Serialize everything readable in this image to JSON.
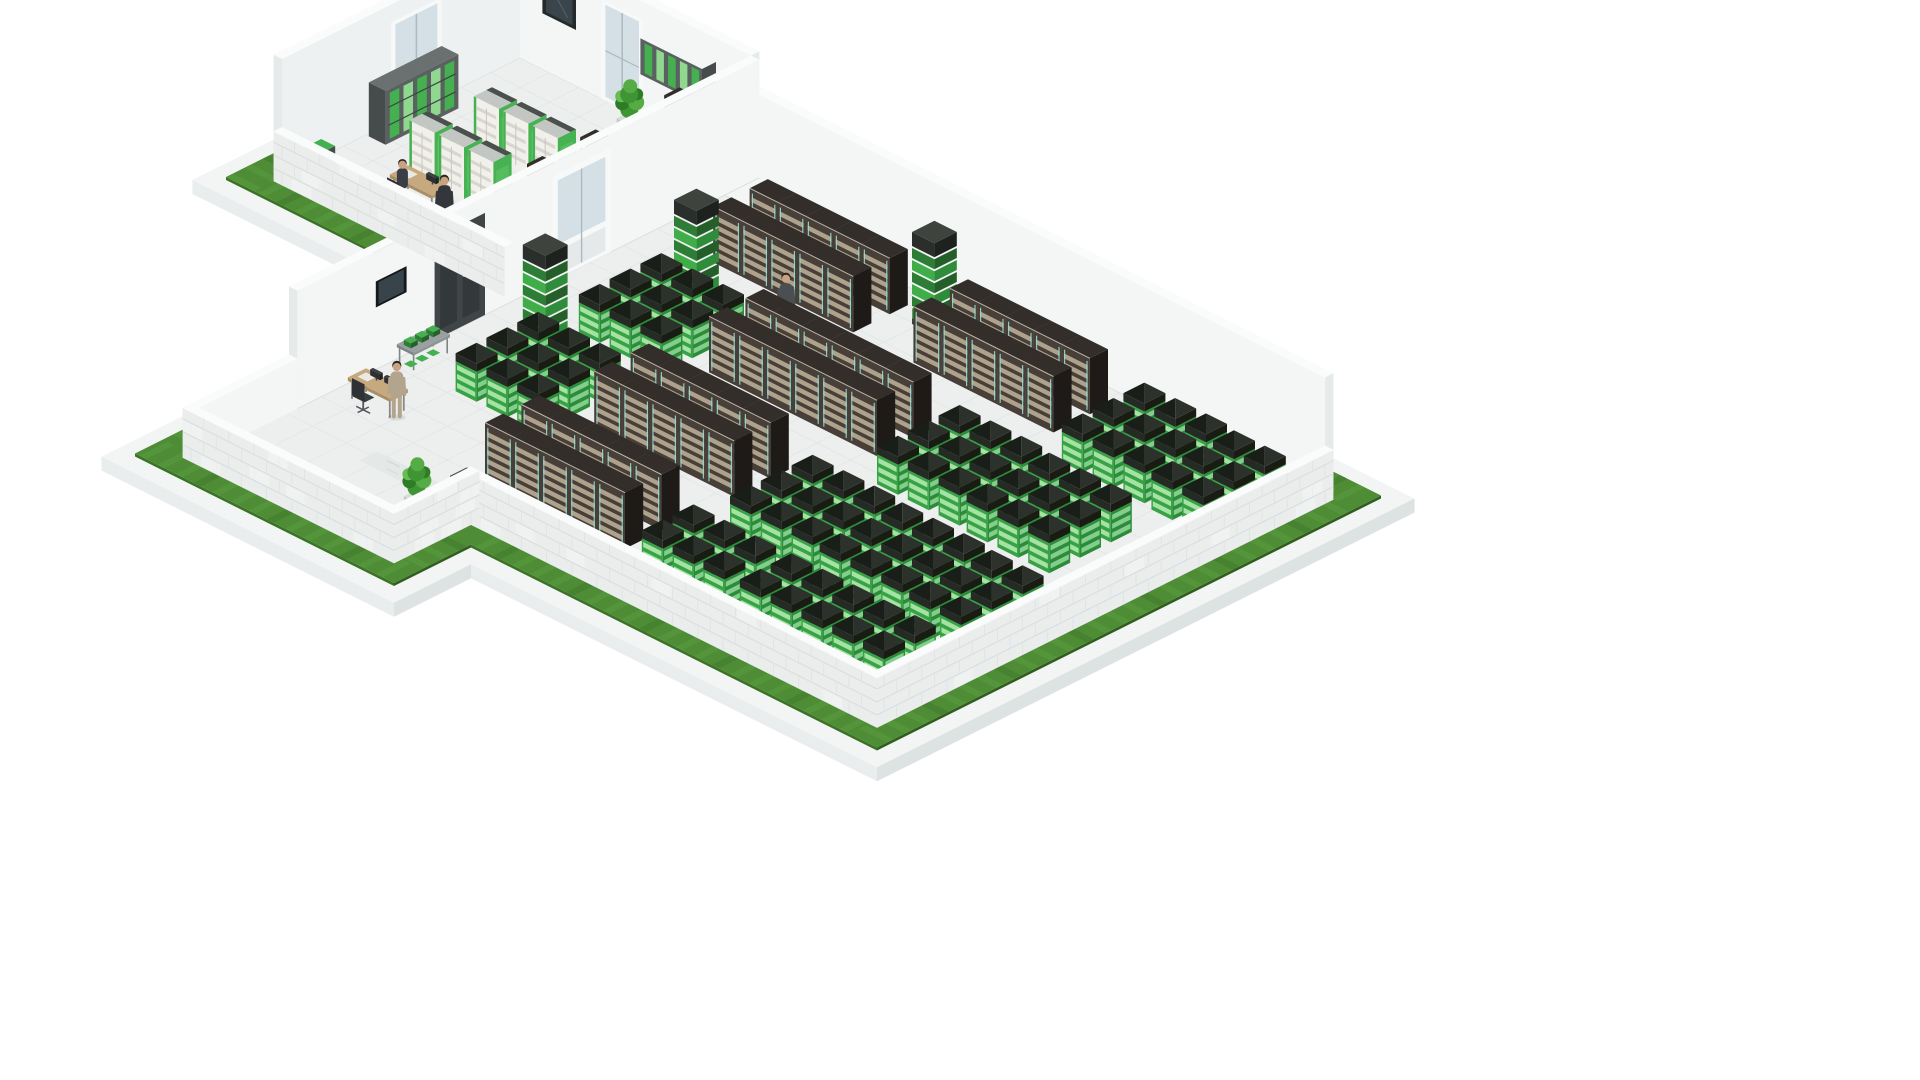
{
  "illustration": {
    "subject": "isometric-data-center-cutaway-illustration",
    "background": "#ffffff"
  },
  "palette": {
    "bg": "#ffffff",
    "grassTop": "#4e8c35",
    "grassLight": "#66a94a",
    "grassDark": "#33691f",
    "grassEdgeY": "#3a7226",
    "grassEdgeX": "#2f5e1d",
    "plinthTop": "#f3f5f5",
    "plinthSideY": "#e9edee",
    "plinthSideX": "#dde2e3",
    "floor": "#edefee",
    "floorLine": "#e0e5e4",
    "walkway": "#e4e8e7",
    "fleck": "#cdd3d2",
    "wallFace": "#f4f6f6",
    "wallFace2": "#eef1f1",
    "wallTop": "#fafbfb",
    "wallEnd": "#e7eaea",
    "brickBase": "#eaedec",
    "brickLine": "#d6dbda",
    "brickLight": "#f6f8f7",
    "rackFront": "#473f38",
    "rackStripe": "#c2b49c",
    "rackTeal": "#93dbd1",
    "rackSide": "#1d1a18",
    "rackTop": "#332e2a",
    "rackTopEdge": "#d9d3c6",
    "greenFaceL": "#37a346",
    "greenFaceR": "#2c8c3a",
    "greenStripeL": "#b9edb4",
    "greenStripeR": "#9adfa1",
    "greenCapA": "#2d312c",
    "greenCapB": "#1a1e19",
    "greenBandL": "#262a25",
    "greenBandR": "#181c13",
    "batFront": "#f1f0ea",
    "batDrawer": "#d8d6ce",
    "batSide": "#47b251",
    "batTop": "#4a514c",
    "batTopLight": "#c3c7c3",
    "batSeam": "#c9c7bf",
    "axRack": "#25221f",
    "axRackSide": "#1a1715",
    "axRackTop": "#332e2a",
    "axPanel": "#e0e3e3",
    "shelfFrame": "#5b6161",
    "shelfDark": "#464c4c",
    "slatA": "#44b04f",
    "slatB": "#90d890",
    "towerA": "#3fae49",
    "towerB": "#2e7d36",
    "towerA2": "#2f8c3a",
    "towerB2": "#245f2a",
    "towerCap": "#2b2f2b",
    "towerCapTop": "#3e433e",
    "glass": "#d4e0e5",
    "frameWhite": "#f7f9f9",
    "frameDark": "#24292b",
    "windowInner": "#3a444b",
    "mullion": "#a9bac0",
    "doorDark": "#404548",
    "doorPanel": "#33383a",
    "deskTop": "#c7a97f",
    "deskSideL": "#a98e67",
    "deskSideR": "#b79b72",
    "deskLeg": "#8b897f",
    "monitor": "#2d3032",
    "monitorTop": "#3a3e40",
    "chair": "#3b3e41",
    "pot": "#dadcda",
    "potSideL": "#c6c9c6",
    "potSideX": "#b9bcb9",
    "leaf1": "#2e7c26",
    "leaf2": "#3f9433",
    "leaf3": "#56ac44",
    "leaf4": "#68bc53",
    "trayTopA": "#2f8a3a",
    "trayTopB": "#1f5a28",
    "traySideY": "#1c3320",
    "traySideX": "#173021",
    "skin": "#c9a183",
    "hair": "#2b2522",
    "screenDark": "#15191b",
    "screenInner": "#39434a",
    "consoleTop": "#9aa0a0",
    "consoleSide": "#7e8585",
    "cabFace": "#3a3f41",
    "cabSide": "#2c3133",
    "cabTop": "#474c4e"
  },
  "iso": {
    "ox": 520,
    "oy": 58,
    "kx": 1.4,
    "ky": 0.7
  },
  "geometry": {
    "wallTall": 118,
    "wallLow": 50,
    "footprint": [
      [
        0,
        0
      ],
      [
        165,
        0
      ],
      [
        165,
        25
      ],
      [
        600,
        25
      ],
      [
        600,
        345
      ],
      [
        310,
        345
      ],
      [
        310,
        400
      ],
      [
        165,
        400
      ],
      [
        165,
        170
      ],
      [
        0,
        170
      ]
    ],
    "grass": [
      [
        -20,
        -20
      ],
      [
        185,
        -20
      ],
      [
        185,
        5
      ],
      [
        620,
        5
      ],
      [
        620,
        365
      ],
      [
        330,
        365
      ],
      [
        330,
        420
      ],
      [
        145,
        420
      ],
      [
        145,
        190
      ],
      [
        -20,
        190
      ]
    ],
    "plinth": [
      [
        -32,
        -32
      ],
      [
        197,
        -32
      ],
      [
        197,
        -7
      ],
      [
        632,
        -7
      ],
      [
        632,
        377
      ],
      [
        342,
        377
      ],
      [
        342,
        432
      ],
      [
        133,
        432
      ],
      [
        133,
        202
      ],
      [
        -32,
        202
      ]
    ],
    "grassBands": [
      [
        -20,
        185,
        -20,
        0
      ],
      [
        185,
        620,
        5,
        25
      ],
      [
        600,
        620,
        25,
        365
      ],
      [
        330,
        600,
        345,
        365
      ],
      [
        310,
        330,
        365,
        400
      ],
      [
        145,
        330,
        400,
        420
      ],
      [
        145,
        165,
        190,
        400
      ],
      [
        0,
        145,
        170,
        190
      ],
      [
        -20,
        0,
        0,
        190
      ]
    ],
    "grassEdgesY": [
      [
        330,
        620,
        365
      ],
      [
        145,
        330,
        420
      ],
      [
        -20,
        145,
        190
      ]
    ],
    "grassEdgesX": [
      [
        5,
        365,
        620
      ],
      [
        365,
        420,
        330
      ],
      [
        -20,
        5,
        185
      ]
    ],
    "plinthEdgesY": [
      [
        342,
        632,
        377
      ],
      [
        133,
        342,
        432
      ],
      [
        -32,
        133,
        202
      ]
    ],
    "plinthEdgesX": [
      [
        -7,
        377,
        632
      ],
      [
        377,
        432,
        342
      ],
      [
        -32,
        -7,
        197
      ]
    ],
    "rooms": {
      "annex": [
        0,
        165,
        0,
        170,
        21
      ],
      "hall": [
        165,
        600,
        25,
        345,
        24
      ],
      "alcove": [
        165,
        310,
        345,
        400,
        24
      ]
    },
    "walkway": [
      230,
      600,
      332,
      345
    ]
  },
  "openings": {
    "annexBackDoor": {
      "x0": 58,
      "x1": 88
    },
    "annexBackWindow": {
      "x0": 16,
      "x1": 40,
      "z0": 56,
      "z1": 96
    },
    "annexLeftDoor": {
      "y0": 56,
      "y1": 92
    },
    "wallCabinet": {
      "x0": 96,
      "x1": 140,
      "z0": 58,
      "z1": 94
    },
    "dividerWhiteDoor": {
      "y0": 106,
      "y1": 148
    },
    "dividerDarkDoor": {
      "y0": 196,
      "y1": 232
    },
    "wallScreen": {
      "y0": 252,
      "y1": 274,
      "z0": 62,
      "z1": 88
    }
  },
  "objects": {
    "annex": [
      {
        "t": "bookshelf",
        "name": "green-storage-shelf",
        "x": 2,
        "y": 58
      },
      {
        "t": "corner-cab",
        "name": "storage-cabinet",
        "x": 4,
        "y": 146
      },
      {
        "t": "battery",
        "name": "ups-battery-cabinet",
        "x": 48,
        "y": 68
      },
      {
        "t": "battery",
        "name": "ups-battery-cabinet",
        "x": 69,
        "y": 68
      },
      {
        "t": "battery",
        "name": "ups-battery-cabinet",
        "x": 90,
        "y": 68
      },
      {
        "t": "battery",
        "name": "ups-battery-cabinet",
        "x": 42,
        "y": 108
      },
      {
        "t": "battery",
        "name": "ups-battery-cabinet",
        "x": 63,
        "y": 108
      },
      {
        "t": "battery",
        "name": "ups-battery-cabinet",
        "x": 84,
        "y": 108
      },
      {
        "t": "annex-rack",
        "name": "network-rack",
        "x": 118,
        "y": 4,
        "panel": false
      },
      {
        "t": "annex-rack",
        "name": "network-rack",
        "x": 133,
        "y": 4,
        "panel": true
      },
      {
        "t": "annex-rack",
        "name": "network-rack",
        "x": 148,
        "y": 4,
        "panel": false
      },
      {
        "t": "annex-rack",
        "name": "network-rack",
        "x": 118,
        "y": 64,
        "panel": true
      },
      {
        "t": "annex-rack",
        "name": "network-rack",
        "x": 133,
        "y": 64,
        "panel": false
      },
      {
        "t": "annex-rack",
        "name": "network-rack",
        "x": 148,
        "y": 64,
        "panel": true
      },
      {
        "t": "annex-rack",
        "name": "network-rack",
        "x": 118,
        "y": 102,
        "panel": false
      },
      {
        "t": "annex-rack",
        "name": "network-rack",
        "x": 133,
        "y": 102,
        "panel": true
      },
      {
        "t": "annex-rack",
        "name": "network-rack",
        "x": 148,
        "y": 102,
        "panel": false
      },
      {
        "t": "desk",
        "name": "office-desk",
        "x": 52,
        "y": 132,
        "w": 30,
        "d": 13,
        "monitors": 1
      },
      {
        "t": "person",
        "name": "person-sitting",
        "x": 64,
        "y": 148,
        "pose": "sitting",
        "suit": "#3a3e45"
      },
      {
        "t": "chair",
        "name": "office-chair",
        "x": 65,
        "y": 152
      },
      {
        "t": "person",
        "name": "person-walking",
        "x": 96,
        "y": 150,
        "pose": "walking",
        "suit": "#33373c",
        "briefcase": true
      },
      {
        "t": "plant",
        "name": "potted-plant",
        "x": 84,
        "y": 6
      },
      {
        "t": "tray",
        "name": "floor-cable-tray",
        "x": 10,
        "y": 160,
        "n": 7,
        "step": 15
      }
    ],
    "hall": [
      {
        "t": "tower",
        "name": "green-cooling-tower",
        "x": 200,
        "y": 182
      },
      {
        "t": "tower",
        "name": "green-cooling-tower",
        "x": 330,
        "y": 34
      },
      {
        "t": "tower",
        "name": "green-cooling-tower",
        "x": 222,
        "y": 96
      },
      {
        "t": "dark-row",
        "name": "server-rack-row",
        "x": 215,
        "y": 38,
        "n": 5,
        "rows": 2
      },
      {
        "t": "dark-row",
        "name": "server-rack-row",
        "x": 358,
        "y": 38,
        "n": 5,
        "rows": 2
      },
      {
        "t": "green-cluster",
        "name": "green-server-cluster",
        "x": 482,
        "y": 36,
        "cols": 3,
        "rows": 3
      },
      {
        "t": "green-cluster",
        "name": "green-server-cluster",
        "x": 548,
        "y": 38,
        "cols": 2,
        "rows": 3
      },
      {
        "t": "green-cluster",
        "name": "green-server-cluster",
        "x": 217,
        "y": 116,
        "cols": 3,
        "rows": 3
      },
      {
        "t": "dark-row",
        "name": "server-rack-row",
        "x": 292,
        "y": 118,
        "n": 6,
        "rows": 2
      },
      {
        "t": "green-cluster",
        "name": "green-server-cluster",
        "x": 432,
        "y": 118,
        "cols": 3,
        "rows": 3
      },
      {
        "t": "green-cluster",
        "name": "green-server-cluster",
        "x": 498,
        "y": 120,
        "cols": 3,
        "rows": 3
      },
      {
        "t": "green-cluster",
        "name": "green-server-cluster",
        "x": 215,
        "y": 202,
        "cols": 3,
        "rows": 3
      },
      {
        "t": "dark-row",
        "name": "server-rack-row",
        "x": 290,
        "y": 198,
        "n": 5,
        "rows": 2
      },
      {
        "t": "green-cluster",
        "name": "green-server-cluster",
        "x": 415,
        "y": 206,
        "cols": 3,
        "rows": 3
      },
      {
        "t": "green-cluster",
        "name": "green-server-cluster",
        "x": 481,
        "y": 208,
        "cols": 3,
        "rows": 3
      },
      {
        "t": "green-cluster",
        "name": "green-server-cluster",
        "x": 547,
        "y": 210,
        "cols": 2,
        "rows": 3
      },
      {
        "t": "dark-row",
        "name": "server-rack-row",
        "x": 288,
        "y": 274,
        "n": 5,
        "rows": 2
      },
      {
        "t": "green-cluster",
        "name": "green-server-cluster",
        "x": 408,
        "y": 284,
        "cols": 3,
        "rows": 2
      },
      {
        "t": "green-cluster",
        "name": "green-server-cluster",
        "x": 478,
        "y": 284,
        "cols": 3,
        "rows": 2
      },
      {
        "t": "green-cluster",
        "name": "green-server-cluster",
        "x": 544,
        "y": 284,
        "cols": 2,
        "rows": 2
      },
      {
        "t": "console",
        "name": "console-table",
        "x": 174,
        "y": 236
      },
      {
        "t": "desk",
        "name": "office-desk",
        "x": 182,
        "y": 292,
        "w": 30,
        "d": 13,
        "monitors": 2
      },
      {
        "t": "chair",
        "name": "office-chair",
        "x": 196,
        "y": 308
      },
      {
        "t": "person",
        "name": "person-standing",
        "x": 212,
        "y": 300,
        "pose": "standing",
        "suit": "#b3a48e"
      },
      {
        "t": "cabinet",
        "name": "dark-cabinet",
        "x": 292,
        "y": 330
      },
      {
        "t": "plant",
        "name": "potted-plant",
        "x": 278,
        "y": 352
      },
      {
        "t": "person",
        "name": "person-walking",
        "x": 288,
        "y": 98,
        "pose": "walking",
        "suit": "#4a4f52",
        "briefcase": false
      },
      {
        "t": "person",
        "name": "person-standing",
        "x": 566,
        "y": 298,
        "pose": "standing",
        "suit": "#5c6054"
      }
    ]
  }
}
